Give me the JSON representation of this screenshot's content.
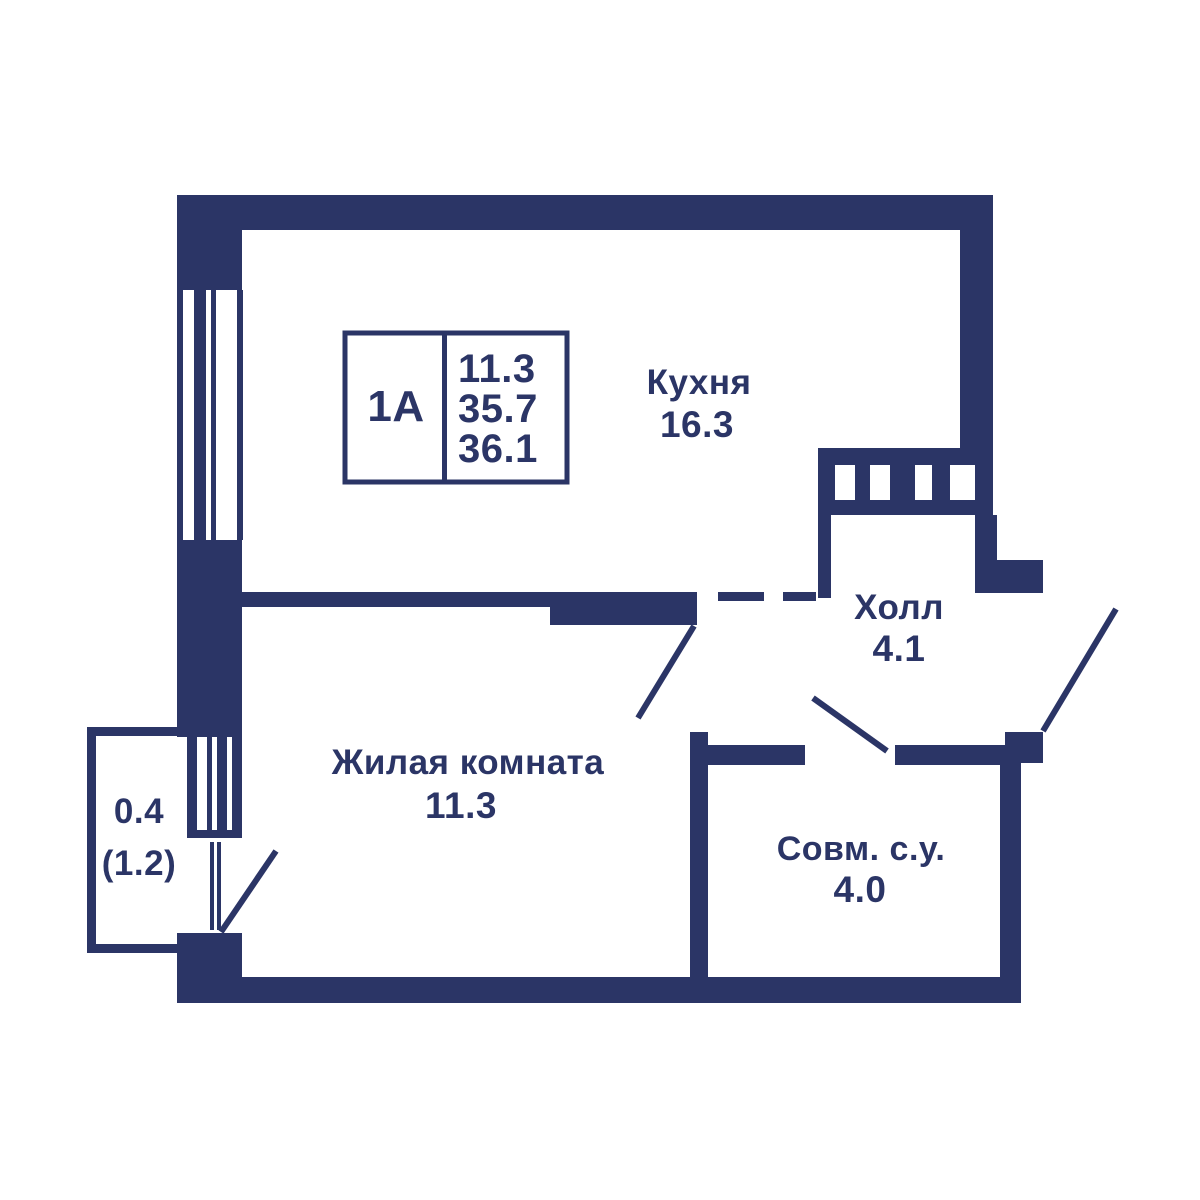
{
  "colors": {
    "wall": "#2b3566",
    "text": "#2b3566",
    "background": "#ffffff"
  },
  "info_box": {
    "unit": "1A",
    "values": [
      "11.3",
      "35.7",
      "36.1"
    ]
  },
  "rooms": {
    "kitchen": {
      "name": "Кухня",
      "area": "16.3"
    },
    "hall": {
      "name": "Холл",
      "area": "4.1"
    },
    "living": {
      "name": "Жилая комната",
      "area": "11.3"
    },
    "bathroom": {
      "name": "Совм. с.у.",
      "area": "4.0"
    },
    "balcony": {
      "area": "0.4",
      "area_with_coeff": "(1.2)"
    }
  }
}
